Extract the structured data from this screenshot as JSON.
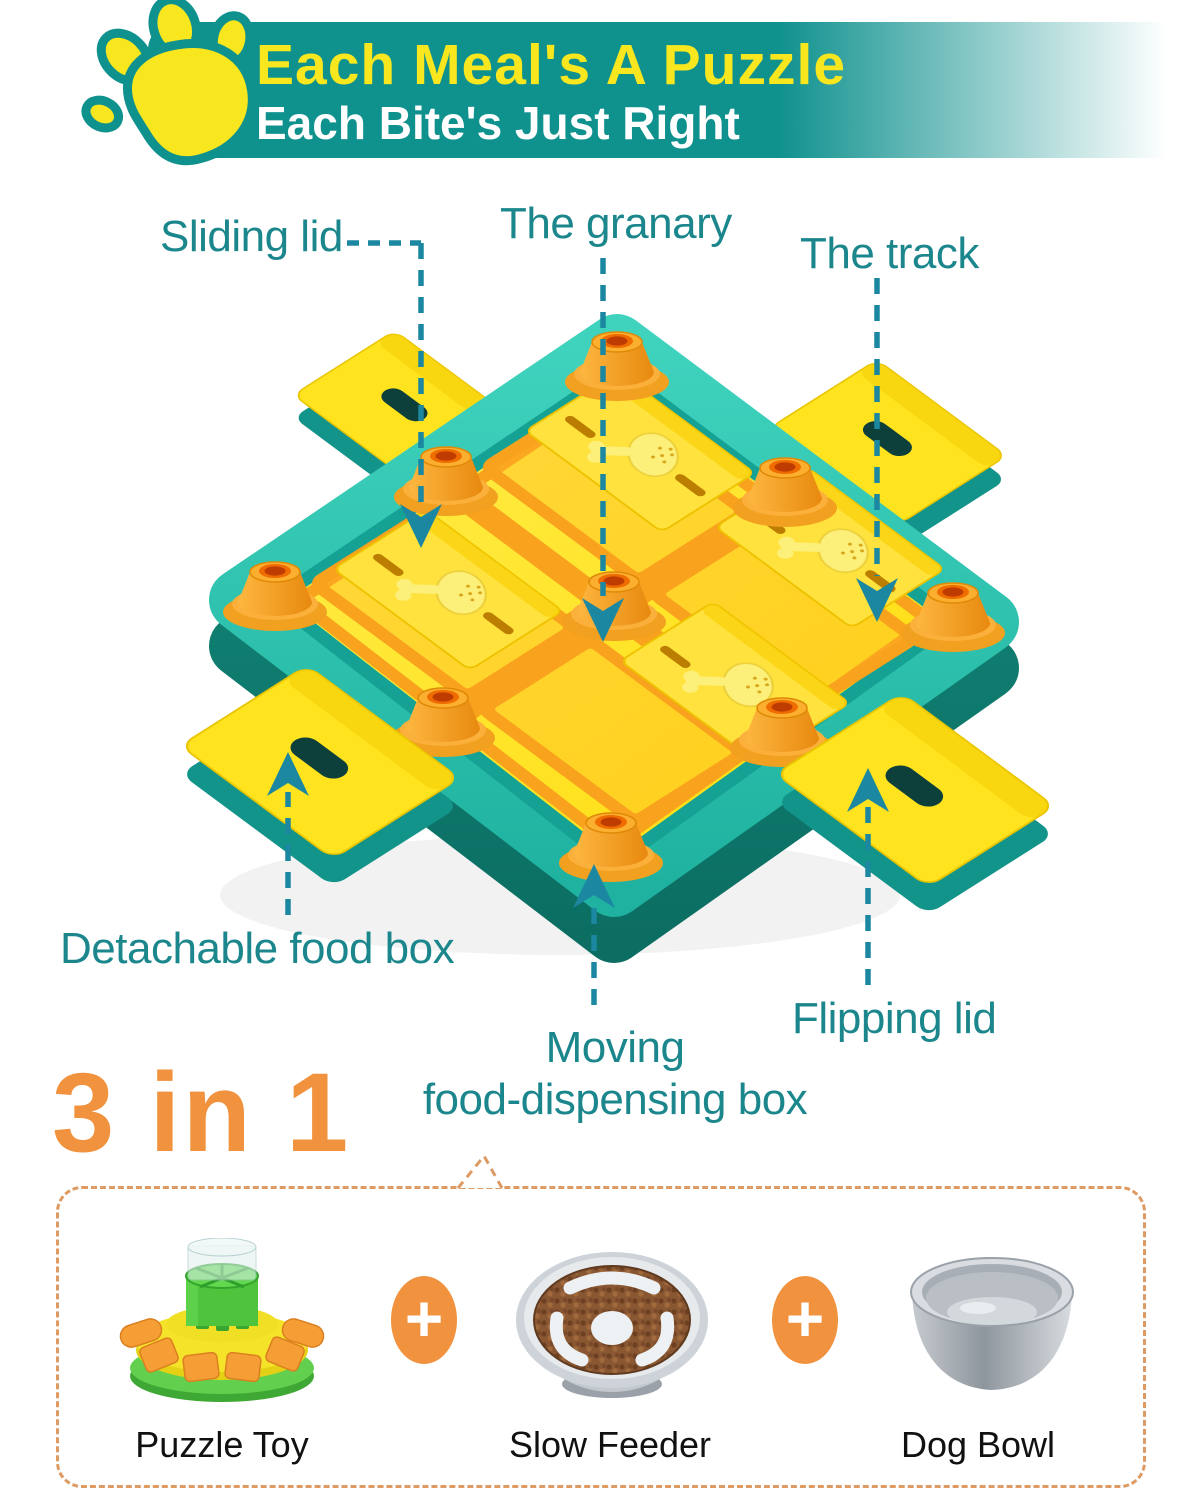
{
  "header": {
    "title": "Each Meal's A Puzzle",
    "subtitle": "Each Bite's Just Right"
  },
  "callouts": {
    "sliding_lid": "Sliding lid",
    "granary": "The granary",
    "track": "The track",
    "detachable_food_box": "Detachable food box",
    "moving_line1": "Moving",
    "moving_line2": "food-dispensing box",
    "flipping_lid": "Flipping lid"
  },
  "bottom": {
    "headline": "3 in 1",
    "plus": "+",
    "items": [
      {
        "label": "Puzzle Toy"
      },
      {
        "label": "Slow Feeder"
      },
      {
        "label": "Dog Bowl"
      }
    ]
  },
  "colors": {
    "banner": "#0f918e",
    "title_yellow": "#f8e71e",
    "subtitle_white": "#ffffff",
    "label_teal": "#1b878d",
    "arrow_teal": "#1b87a0",
    "headline_orange": "#f0923e",
    "box_dash_orange": "#dd9a63",
    "item_label_black": "#111111",
    "tray_teal": "#2cc4b0",
    "surface_yellow": "#ffe414",
    "track_orange": "#f9a21d"
  }
}
